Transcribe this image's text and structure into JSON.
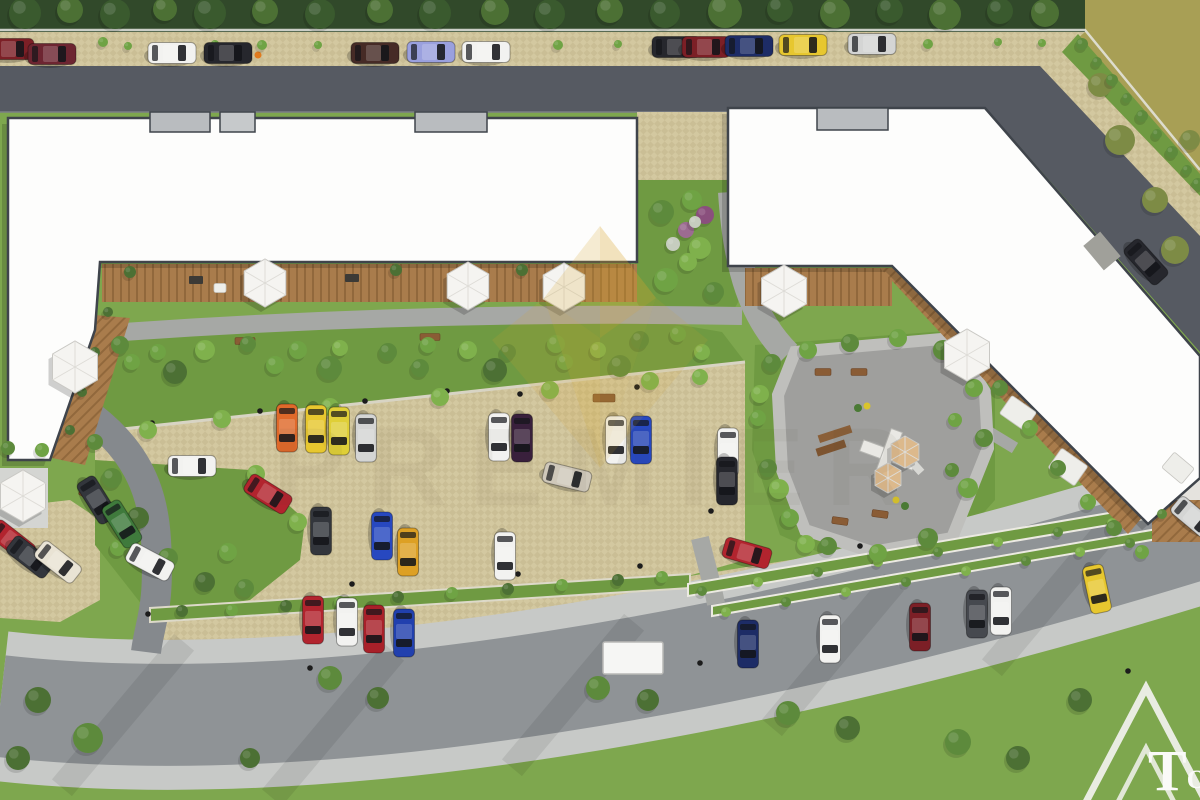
{
  "palette": {
    "asphalt_dark": "#565a62",
    "road_light": "#8f9396",
    "sidewalk": "#c7c9c7",
    "paver": "#d3c8a0",
    "paver_dark": "#c2b68c",
    "wood": "#a97c4c",
    "wood_dark": "#91683c",
    "building": "#fdfdfc",
    "building_outline": "#3f444b",
    "grass": "#7ea74e",
    "garden": "#6f9a42",
    "hedge_dark": "#31492a",
    "olive": "#a89f55",
    "plaza": "#9f9f9d",
    "path": "#a6a8a5",
    "gold": "#d9a62b"
  },
  "watermark": {
    "brand": "PREMIER"
  },
  "logo": {
    "text_large": "T",
    "text_small": "OP"
  },
  "scene": {
    "car_colors": {
      "darkred": "#7c1f26",
      "maroon": "#6d2531",
      "white": "#f2f2f0",
      "black": "#26272d",
      "brown": "#462b26",
      "lavender": "#9aa0de",
      "navy": "#1d2c66",
      "yellow": "#e7c72f",
      "yellow2": "#dfcf37",
      "silver": "#d4d5d4",
      "charcoal": "#33363c",
      "green": "#3f7a3c",
      "cream": "#e9e3d4",
      "red": "#b2242e",
      "red2": "#a82029",
      "orange": "#e0692a",
      "eggplant": "#39203c",
      "blue": "#2748c0",
      "blue2": "#2140ae",
      "beige": "#cfc8ba",
      "amber": "#dda024",
      "gray": "#46494f"
    },
    "cars": [
      [
        10,
        49,
        0,
        "darkred"
      ],
      [
        52,
        54,
        0,
        "maroon"
      ],
      [
        172,
        53,
        0,
        "white"
      ],
      [
        228,
        53,
        0,
        "black"
      ],
      [
        375,
        53,
        0,
        "brown"
      ],
      [
        431,
        52,
        0,
        "lavender"
      ],
      [
        486,
        52,
        0,
        "white"
      ],
      [
        676,
        47,
        0,
        "black"
      ],
      [
        706,
        47,
        0,
        "darkred"
      ],
      [
        749,
        46,
        0,
        "navy"
      ],
      [
        803,
        45,
        0,
        "yellow"
      ],
      [
        872,
        44,
        0,
        "silver"
      ],
      [
        1146,
        262,
        48,
        "black"
      ],
      [
        97,
        500,
        58,
        "charcoal"
      ],
      [
        122,
        524,
        58,
        "green"
      ],
      [
        150,
        562,
        28,
        "white"
      ],
      [
        192,
        466,
        0,
        "white"
      ],
      [
        12,
        541,
        38,
        "red"
      ],
      [
        30,
        557,
        38,
        "charcoal"
      ],
      [
        58,
        562,
        38,
        "cream"
      ],
      [
        287,
        428,
        90,
        "orange"
      ],
      [
        316,
        429,
        90,
        "yellow"
      ],
      [
        339,
        431,
        90,
        "yellow2"
      ],
      [
        366,
        438,
        90,
        "silver"
      ],
      [
        499,
        437,
        90,
        "white"
      ],
      [
        522,
        438,
        90,
        "eggplant"
      ],
      [
        616,
        440,
        90,
        "white"
      ],
      [
        641,
        440,
        90,
        "blue"
      ],
      [
        728,
        452,
        90,
        "white"
      ],
      [
        727,
        481,
        90,
        "black"
      ],
      [
        567,
        477,
        14,
        "beige"
      ],
      [
        268,
        494,
        32,
        "red"
      ],
      [
        321,
        531,
        90,
        "charcoal"
      ],
      [
        382,
        536,
        90,
        "blue"
      ],
      [
        408,
        552,
        90,
        "amber"
      ],
      [
        505,
        556,
        90,
        "white"
      ],
      [
        313,
        620,
        90,
        "red"
      ],
      [
        347,
        622,
        90,
        "white"
      ],
      [
        374,
        629,
        90,
        "red2"
      ],
      [
        404,
        633,
        90,
        "blue2"
      ],
      [
        748,
        644,
        90,
        "navy"
      ],
      [
        830,
        639,
        90,
        "white"
      ],
      [
        920,
        627,
        90,
        "darkred"
      ],
      [
        977,
        614,
        90,
        "gray"
      ],
      [
        1001,
        611,
        90,
        "white"
      ],
      [
        1097,
        589,
        78,
        "yellow"
      ],
      [
        747,
        553,
        16,
        "red"
      ],
      [
        1194,
        518,
        40,
        "silver"
      ]
    ],
    "tree_colors": [
      "#3a5a2e",
      "#4c7034",
      "#5d8a3c",
      "#6fa344",
      "#7fb14c",
      "#7d8b45",
      "#8a4f7d",
      "#9c6b91",
      "#c6cdbf"
    ],
    "trees": [
      [
        25,
        13,
        16,
        0
      ],
      [
        70,
        10,
        13,
        1
      ],
      [
        115,
        14,
        15,
        0
      ],
      [
        165,
        9,
        12,
        1
      ],
      [
        210,
        13,
        16,
        0
      ],
      [
        265,
        11,
        13,
        1
      ],
      [
        320,
        14,
        15,
        0
      ],
      [
        380,
        10,
        13,
        1
      ],
      [
        435,
        13,
        16,
        0
      ],
      [
        495,
        11,
        14,
        1
      ],
      [
        550,
        14,
        15,
        0
      ],
      [
        610,
        10,
        13,
        1
      ],
      [
        665,
        13,
        15,
        0
      ],
      [
        725,
        11,
        17,
        1
      ],
      [
        780,
        9,
        13,
        0
      ],
      [
        835,
        13,
        15,
        1
      ],
      [
        890,
        10,
        13,
        0
      ],
      [
        945,
        14,
        16,
        1
      ],
      [
        1000,
        11,
        13,
        0
      ],
      [
        1045,
        13,
        14,
        1
      ],
      [
        103,
        42,
        5,
        3
      ],
      [
        128,
        46,
        4,
        3
      ],
      [
        215,
        44,
        4,
        3
      ],
      [
        262,
        45,
        5,
        3
      ],
      [
        318,
        45,
        4,
        3
      ],
      [
        558,
        45,
        5,
        3
      ],
      [
        618,
        44,
        4,
        3
      ],
      [
        928,
        44,
        5,
        3
      ],
      [
        998,
        42,
        4,
        3
      ],
      [
        1042,
        43,
        4,
        3
      ],
      [
        1120,
        140,
        15,
        5
      ],
      [
        1155,
        200,
        13,
        5
      ],
      [
        1100,
        85,
        12,
        5
      ],
      [
        1175,
        250,
        14,
        5
      ],
      [
        1190,
        140,
        10,
        5
      ],
      [
        1082,
        44,
        6,
        2
      ],
      [
        1097,
        62,
        5,
        2
      ],
      [
        1112,
        80,
        6,
        2
      ],
      [
        1127,
        98,
        5,
        2
      ],
      [
        1142,
        116,
        6,
        2
      ],
      [
        1157,
        134,
        5,
        2
      ],
      [
        1172,
        152,
        6,
        2
      ],
      [
        1187,
        170,
        5,
        2
      ],
      [
        1198,
        184,
        6,
        2
      ],
      [
        662,
        212,
        12,
        2
      ],
      [
        692,
        200,
        10,
        3
      ],
      [
        700,
        248,
        11,
        4
      ],
      [
        666,
        280,
        12,
        3
      ],
      [
        714,
        292,
        10,
        2
      ],
      [
        688,
        262,
        9,
        4
      ],
      [
        705,
        215,
        9,
        6
      ],
      [
        686,
        230,
        8,
        7
      ],
      [
        673,
        244,
        7,
        8
      ],
      [
        695,
        222,
        6,
        8
      ],
      [
        120,
        345,
        9,
        2
      ],
      [
        158,
        352,
        8,
        3
      ],
      [
        205,
        350,
        10,
        4
      ],
      [
        248,
        344,
        8,
        2
      ],
      [
        298,
        350,
        9,
        3
      ],
      [
        340,
        348,
        8,
        4
      ],
      [
        388,
        352,
        9,
        2
      ],
      [
        428,
        345,
        8,
        3
      ],
      [
        468,
        350,
        9,
        4
      ],
      [
        508,
        352,
        8,
        2
      ],
      [
        556,
        344,
        9,
        3
      ],
      [
        598,
        350,
        8,
        4
      ],
      [
        640,
        340,
        9,
        2
      ],
      [
        678,
        334,
        8,
        3
      ],
      [
        702,
        352,
        8,
        4
      ],
      [
        175,
        372,
        12,
        1
      ],
      [
        330,
        368,
        12,
        2
      ],
      [
        495,
        370,
        12,
        1
      ],
      [
        620,
        366,
        11,
        2
      ],
      [
        132,
        362,
        8,
        3
      ],
      [
        275,
        365,
        9,
        3
      ],
      [
        420,
        368,
        9,
        2
      ],
      [
        565,
        362,
        8,
        3
      ],
      [
        148,
        430,
        9,
        4
      ],
      [
        222,
        419,
        9,
        4
      ],
      [
        330,
        407,
        9,
        4
      ],
      [
        440,
        397,
        9,
        4
      ],
      [
        550,
        390,
        9,
        4
      ],
      [
        650,
        381,
        9,
        4
      ],
      [
        700,
        377,
        8,
        4
      ],
      [
        112,
        478,
        10,
        2
      ],
      [
        138,
        518,
        11,
        1
      ],
      [
        168,
        558,
        10,
        2
      ],
      [
        205,
        582,
        10,
        1
      ],
      [
        245,
        588,
        9,
        2
      ],
      [
        228,
        552,
        9,
        3
      ],
      [
        256,
        474,
        9,
        4
      ],
      [
        298,
        522,
        9,
        4
      ],
      [
        118,
        548,
        8,
        3
      ],
      [
        95,
        442,
        8,
        2
      ],
      [
        42,
        450,
        7,
        3
      ],
      [
        8,
        448,
        7,
        2
      ],
      [
        182,
        611,
        6,
        1
      ],
      [
        232,
        610,
        6,
        3
      ],
      [
        286,
        606,
        6,
        1
      ],
      [
        340,
        602,
        6,
        3
      ],
      [
        398,
        597,
        6,
        1
      ],
      [
        452,
        593,
        6,
        3
      ],
      [
        508,
        589,
        6,
        1
      ],
      [
        562,
        585,
        6,
        3
      ],
      [
        618,
        580,
        6,
        1
      ],
      [
        662,
        577,
        6,
        3
      ],
      [
        702,
        591,
        5,
        2
      ],
      [
        758,
        582,
        5,
        4
      ],
      [
        818,
        572,
        5,
        2
      ],
      [
        878,
        562,
        5,
        4
      ],
      [
        938,
        552,
        5,
        2
      ],
      [
        998,
        542,
        5,
        4
      ],
      [
        1058,
        532,
        5,
        2
      ],
      [
        1112,
        523,
        5,
        4
      ],
      [
        1162,
        514,
        5,
        2
      ],
      [
        726,
        612,
        5,
        4
      ],
      [
        786,
        602,
        5,
        2
      ],
      [
        846,
        592,
        5,
        4
      ],
      [
        906,
        582,
        5,
        2
      ],
      [
        966,
        571,
        5,
        4
      ],
      [
        1026,
        561,
        5,
        2
      ],
      [
        1080,
        552,
        5,
        4
      ],
      [
        1130,
        543,
        5,
        2
      ],
      [
        772,
        363,
        9,
        2
      ],
      [
        808,
        350,
        9,
        3
      ],
      [
        850,
        343,
        9,
        2
      ],
      [
        898,
        338,
        9,
        3
      ],
      [
        943,
        350,
        10,
        2
      ],
      [
        974,
        388,
        9,
        3
      ],
      [
        984,
        438,
        9,
        2
      ],
      [
        968,
        488,
        10,
        3
      ],
      [
        928,
        538,
        10,
        2
      ],
      [
        878,
        553,
        9,
        3
      ],
      [
        828,
        546,
        9,
        2
      ],
      [
        790,
        518,
        9,
        3
      ],
      [
        768,
        468,
        9,
        2
      ],
      [
        758,
        418,
        8,
        3
      ],
      [
        779,
        489,
        10,
        4
      ],
      [
        806,
        544,
        9,
        4
      ],
      [
        760,
        394,
        9,
        4
      ],
      [
        955,
        420,
        7,
        3
      ],
      [
        952,
        470,
        7,
        2
      ],
      [
        1000,
        388,
        8,
        2
      ],
      [
        1030,
        428,
        8,
        3
      ],
      [
        1058,
        468,
        8,
        2
      ],
      [
        1088,
        502,
        8,
        3
      ],
      [
        1114,
        528,
        8,
        2
      ],
      [
        1142,
        552,
        7,
        3
      ],
      [
        38,
        700,
        13,
        1
      ],
      [
        88,
        738,
        15,
        2
      ],
      [
        18,
        758,
        12,
        1
      ],
      [
        330,
        678,
        12,
        2
      ],
      [
        378,
        698,
        11,
        1
      ],
      [
        598,
        688,
        12,
        2
      ],
      [
        648,
        700,
        11,
        1
      ],
      [
        788,
        713,
        12,
        2
      ],
      [
        848,
        728,
        12,
        1
      ],
      [
        958,
        742,
        13,
        2
      ],
      [
        1018,
        758,
        12,
        1
      ],
      [
        250,
        758,
        10,
        1
      ],
      [
        1080,
        700,
        12,
        1
      ],
      [
        130,
        272,
        6,
        1
      ],
      [
        262,
        272,
        6,
        1
      ],
      [
        396,
        270,
        6,
        1
      ],
      [
        522,
        270,
        6,
        1
      ],
      [
        108,
        312,
        5,
        1
      ],
      [
        95,
        352,
        5,
        1
      ],
      [
        82,
        392,
        5,
        1
      ],
      [
        70,
        430,
        5,
        1
      ]
    ],
    "umbrellas": [
      [
        265,
        283,
        24
      ],
      [
        468,
        286,
        24
      ],
      [
        564,
        287,
        24
      ],
      [
        75,
        367,
        26
      ],
      [
        23,
        496,
        26
      ],
      [
        784,
        291,
        26
      ],
      [
        967,
        355,
        26
      ]
    ],
    "tan_umbrellas": [
      [
        905,
        452,
        16
      ],
      [
        888,
        478,
        15
      ]
    ],
    "bollards": [
      [
        447,
        391
      ],
      [
        520,
        394
      ],
      [
        637,
        387
      ],
      [
        700,
        382
      ],
      [
        365,
        401
      ],
      [
        260,
        411
      ],
      [
        152,
        423
      ],
      [
        352,
        584
      ],
      [
        518,
        574
      ],
      [
        640,
        566
      ],
      [
        711,
        511
      ],
      [
        860,
        546
      ],
      [
        1128,
        671
      ],
      [
        310,
        668
      ],
      [
        148,
        614
      ],
      [
        700,
        663
      ]
    ],
    "hydrant": [
      258,
      55
    ],
    "benches": [
      [
        823,
        372,
        16,
        7,
        0
      ],
      [
        859,
        372,
        16,
        7,
        0
      ],
      [
        840,
        521,
        16,
        7,
        8
      ],
      [
        880,
        514,
        16,
        7,
        8
      ],
      [
        604,
        398,
        22,
        8,
        0
      ],
      [
        245,
        341,
        20,
        7,
        0
      ],
      [
        430,
        337,
        20,
        7,
        0
      ],
      [
        87,
        495,
        16,
        7,
        30
      ]
    ],
    "seats": [
      [
        1018,
        413,
        30,
        22,
        35
      ],
      [
        1068,
        467,
        32,
        24,
        35
      ],
      [
        1178,
        468,
        26,
        20,
        40
      ],
      [
        220,
        288,
        12,
        9,
        0
      ],
      [
        475,
        292,
        12,
        9,
        0
      ]
    ],
    "deck_items": [
      [
        196,
        280,
        14,
        8
      ],
      [
        352,
        278,
        14,
        8
      ],
      [
        470,
        281,
        12,
        7
      ],
      [
        560,
        281,
        10,
        6
      ],
      [
        800,
        300,
        12,
        8
      ]
    ]
  }
}
